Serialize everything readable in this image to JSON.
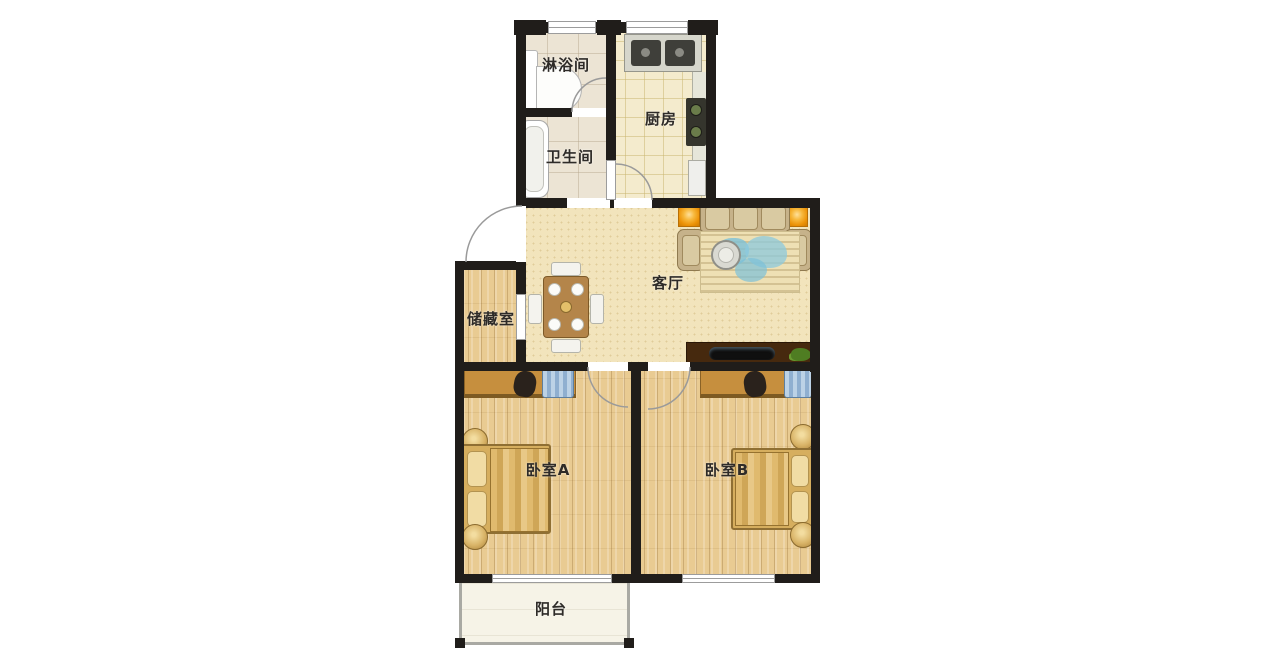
{
  "rooms": {
    "shower": {
      "label": "淋浴间"
    },
    "kitchen": {
      "label": "厨房"
    },
    "bathroom": {
      "label": "卫生间"
    },
    "living": {
      "label": "客厅"
    },
    "storage": {
      "label": "储藏室"
    },
    "bedroom_a": {
      "label": "卧室A"
    },
    "bedroom_b": {
      "label": "卧室B"
    },
    "balcony": {
      "label": "阳台"
    }
  },
  "colors": {
    "wall": "#201d1a",
    "wood_floor": "#e9cb92",
    "living_floor": "#f2e4bc",
    "kitchen_floor": "#f4ebcd",
    "tile_floor": "#ece4d4",
    "balcony_floor": "#f6f3e7",
    "accent_orange": "#ec9207",
    "desk": "#c68f3e",
    "sofa": "#c6b28a",
    "bed_quilt": "#d6ae5e",
    "wardrobe_blue": "#8fafd0",
    "tv_cabinet": "#46290e"
  }
}
